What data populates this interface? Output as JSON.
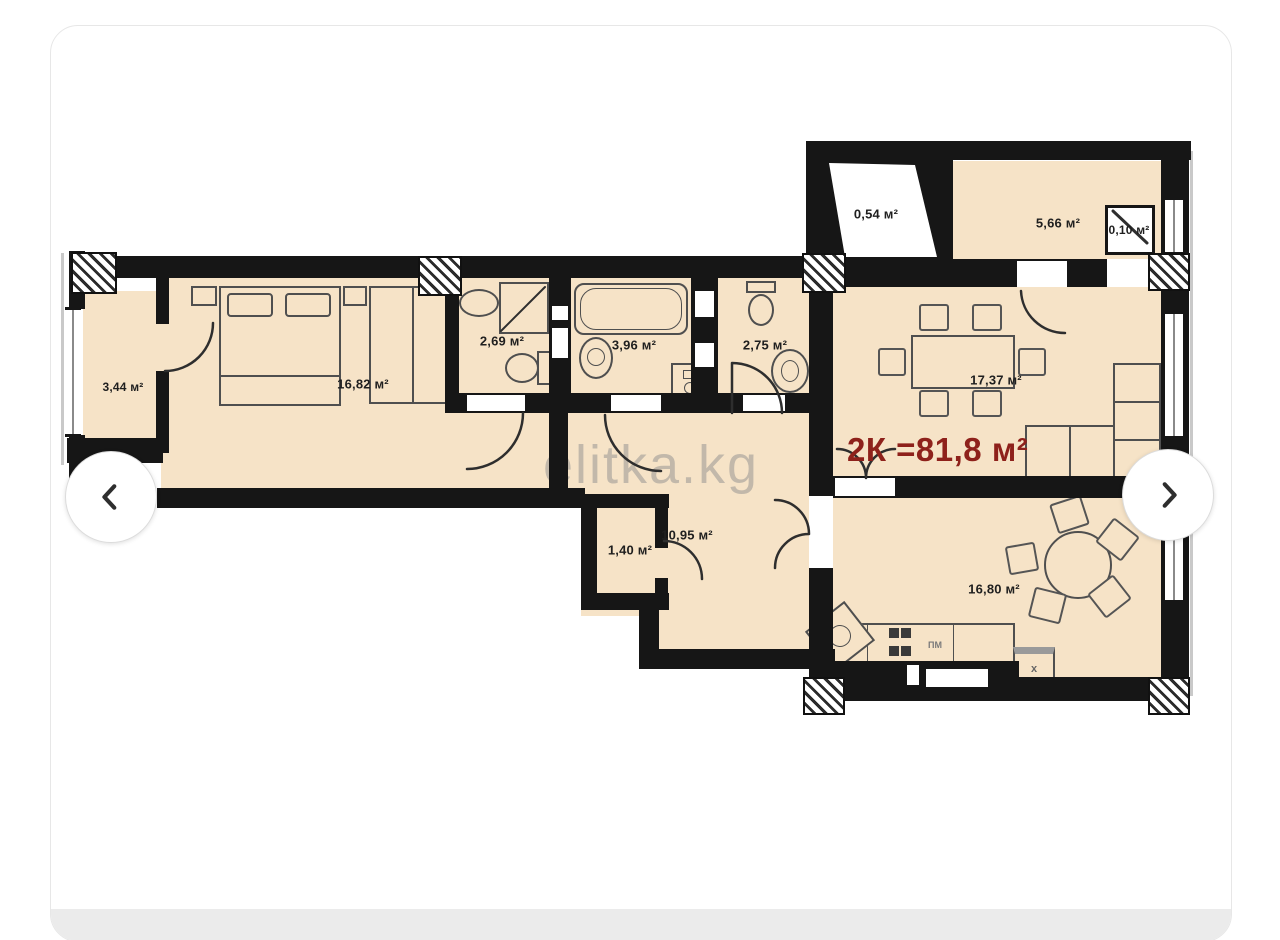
{
  "watermark": {
    "text": "elitka.kg"
  },
  "carousel": {
    "prev_icon": "chevron-left",
    "next_icon": "chevron-right"
  },
  "plan": {
    "title": "2К =81,8 м²",
    "rooms": [
      {
        "name": "balcony",
        "area": "3,44 м²"
      },
      {
        "name": "bedroom",
        "area": "16,82 м²"
      },
      {
        "name": "bathroom-1",
        "area": "2,69 м²"
      },
      {
        "name": "bathroom-2",
        "area": "3,96 м²"
      },
      {
        "name": "bathroom-3",
        "area": "2,75 м²"
      },
      {
        "name": "shaft",
        "area": "0,54 м²"
      },
      {
        "name": "loggia",
        "area": "5,66 м²"
      },
      {
        "name": "duct",
        "area": "0,10 м²"
      },
      {
        "name": "living-room",
        "area": "17,37 м²"
      },
      {
        "name": "hallway",
        "area": "10,95 м²"
      },
      {
        "name": "closet",
        "area": "1,40 м²"
      },
      {
        "name": "kitchen",
        "area": "16,80 м²"
      }
    ],
    "fixtures": {
      "dishwasher": "ПМ",
      "fridge": "х"
    },
    "colors": {
      "floor": "#f6e3c7",
      "wall": "#161616",
      "title": "#8e211b"
    }
  }
}
